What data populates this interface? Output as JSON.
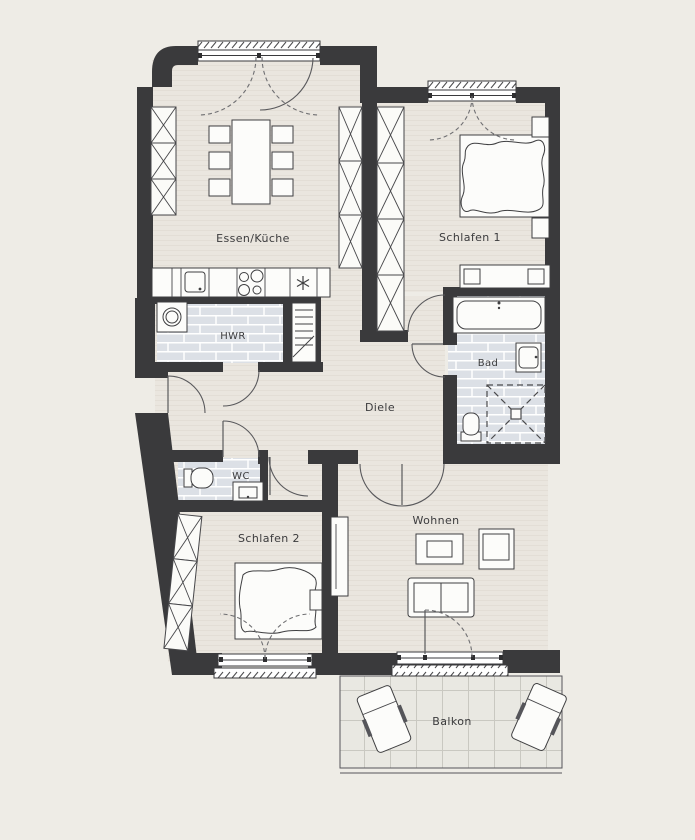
{
  "plan": {
    "title": "Apartment floor plan",
    "rooms": [
      {
        "id": "essen-kueche",
        "label": "Essen/Küche"
      },
      {
        "id": "schlafen1",
        "label": "Schlafen 1"
      },
      {
        "id": "hwr",
        "label": "HWR"
      },
      {
        "id": "bad",
        "label": "Bad"
      },
      {
        "id": "diele",
        "label": "Diele"
      },
      {
        "id": "wc",
        "label": "WC"
      },
      {
        "id": "schlafen2",
        "label": "Schlafen 2"
      },
      {
        "id": "wohnen",
        "label": "Wohnen"
      },
      {
        "id": "balkon",
        "label": "Balkon"
      }
    ],
    "symbols": [
      "dining-table",
      "chair",
      "kitchen-counter",
      "sink",
      "cooktop",
      "fridge-snowflake",
      "washing-machine",
      "radiator-shaft",
      "wardrobe-cross",
      "double-bed",
      "nightstand",
      "dresser",
      "bathtub",
      "washbasin",
      "shower",
      "toilet",
      "sofa",
      "coffee-table",
      "armchair",
      "sideboard",
      "lounge-chair",
      "door-swing",
      "window",
      "roller-shutter"
    ],
    "colors": {
      "background": "#eeece6",
      "wall": "#3a3a3c",
      "floor": "#eae6df",
      "floor_stripe": "#e3ded6",
      "tile": "#dce0e6",
      "tile_grout": "#ffffff",
      "balcony_floor": "#e9e8e2",
      "balcony_grid": "#c9c8c1",
      "furniture_stroke": "#3f3f41",
      "label_text": "#3b3b3d"
    }
  }
}
